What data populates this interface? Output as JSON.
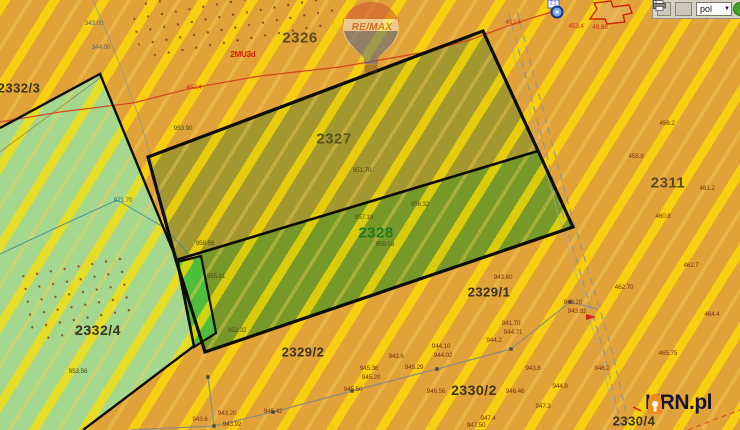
{
  "map": {
    "colors": {
      "orange": "#E2A23A",
      "stripe": "#FFE000",
      "lightgreen": "#A6D78E",
      "olive": "#A3972F",
      "green": "#76992A",
      "brightgreen": "#4FBE3C",
      "border": "#0D0D04"
    },
    "label_colors": {
      "red": "#C83010",
      "maroon": "#7A3410",
      "olive": "#4F4F10",
      "gray": "#5A6878",
      "teal": "#2A7A8A",
      "blue": "#2244CC",
      "zone": "#D42000"
    },
    "toolbar": {
      "language_value": "pol"
    },
    "watermark_remax": {
      "brand": "RE/MAX"
    },
    "watermark_krn": {
      "brand": "KRN.pl"
    },
    "parcel_labels": [
      {
        "text": "2326",
        "x": 300,
        "y": 38,
        "size": 15,
        "color": "#5C4B16"
      },
      {
        "text": "2327",
        "x": 334,
        "y": 139,
        "size": 15,
        "color": "#56561A"
      },
      {
        "text": "2328",
        "x": 376,
        "y": 233,
        "size": 15,
        "color": "#1E7A1E"
      },
      {
        "text": "2311",
        "x": 668,
        "y": 183,
        "size": 15,
        "color": "#5C4B16"
      },
      {
        "text": "2329/1",
        "x": 489,
        "y": 292,
        "size": 13,
        "color": "#3A3318"
      },
      {
        "text": "2329/2",
        "x": 303,
        "y": 352,
        "size": 13,
        "color": "#3A3318"
      },
      {
        "text": "2330/2",
        "x": 474,
        "y": 390,
        "size": 14,
        "color": "#3A3318"
      },
      {
        "text": "2330/4",
        "x": 634,
        "y": 421,
        "size": 13,
        "color": "#3A3318"
      },
      {
        "text": "2332/3",
        "x": 19,
        "y": 88,
        "size": 13,
        "color": "#3A3318"
      },
      {
        "text": "2332/4",
        "x": 98,
        "y": 330,
        "size": 14,
        "color": "#3A3318"
      }
    ],
    "micro_labels": [
      {
        "x": 94,
        "y": 24,
        "text": "343.00",
        "c": "gray"
      },
      {
        "x": 101,
        "y": 48,
        "text": "344.00",
        "c": "gray"
      },
      {
        "x": 243,
        "y": 55,
        "text": "2MU3d",
        "c": "zone",
        "size": 8,
        "bold": true
      },
      {
        "x": 194,
        "y": 88,
        "text": "452.4",
        "c": "red"
      },
      {
        "x": 513,
        "y": 23,
        "text": "452.4",
        "c": "red"
      },
      {
        "x": 576,
        "y": 27,
        "text": "453.4",
        "c": "red"
      },
      {
        "x": 600,
        "y": 28,
        "text": "49.88",
        "c": "red"
      },
      {
        "x": 553,
        "y": 4,
        "text": "2.1",
        "c": "blue",
        "size": 5
      },
      {
        "x": 667,
        "y": 124,
        "text": "456.2",
        "c": "maroon"
      },
      {
        "x": 636,
        "y": 157,
        "text": "458.8",
        "c": "maroon"
      },
      {
        "x": 707,
        "y": 189,
        "text": "461.2",
        "c": "maroon"
      },
      {
        "x": 663,
        "y": 217,
        "text": "460.8",
        "c": "maroon"
      },
      {
        "x": 691,
        "y": 266,
        "text": "462.7",
        "c": "maroon"
      },
      {
        "x": 624,
        "y": 288,
        "text": "462.70",
        "c": "maroon"
      },
      {
        "x": 712,
        "y": 315,
        "text": "464.4",
        "c": "maroon"
      },
      {
        "x": 668,
        "y": 354,
        "text": "465.75",
        "c": "maroon"
      },
      {
        "x": 183,
        "y": 129,
        "text": "953.90",
        "c": "olive"
      },
      {
        "x": 362,
        "y": 171,
        "text": "951.70",
        "c": "olive"
      },
      {
        "x": 420,
        "y": 205,
        "text": "956.32",
        "c": "olive"
      },
      {
        "x": 364,
        "y": 218,
        "text": "957.18",
        "c": "olive"
      },
      {
        "x": 205,
        "y": 244,
        "text": "958.56",
        "c": "olive"
      },
      {
        "x": 385,
        "y": 245,
        "text": "959.56",
        "c": "olive"
      },
      {
        "x": 216,
        "y": 277,
        "text": "955.81",
        "c": "olive"
      },
      {
        "x": 237,
        "y": 331,
        "text": "952.32",
        "c": "olive"
      },
      {
        "x": 78,
        "y": 372,
        "text": "953.56",
        "c": "olive"
      },
      {
        "x": 123,
        "y": 201,
        "text": "971.70",
        "c": "teal"
      },
      {
        "x": 503,
        "y": 278,
        "text": "943.60",
        "c": "maroon"
      },
      {
        "x": 573,
        "y": 303,
        "text": "943.20",
        "c": "maroon"
      },
      {
        "x": 577,
        "y": 312,
        "text": "943.92",
        "c": "maroon"
      },
      {
        "x": 511,
        "y": 324,
        "text": "941.70",
        "c": "maroon"
      },
      {
        "x": 513,
        "y": 333,
        "text": "944.71",
        "c": "maroon"
      },
      {
        "x": 494,
        "y": 341,
        "text": "944.2",
        "c": "maroon"
      },
      {
        "x": 441,
        "y": 347,
        "text": "944.10",
        "c": "maroon"
      },
      {
        "x": 443,
        "y": 356,
        "text": "944.02",
        "c": "maroon"
      },
      {
        "x": 414,
        "y": 368,
        "text": "945.29",
        "c": "maroon"
      },
      {
        "x": 533,
        "y": 369,
        "text": "943.8",
        "c": "maroon"
      },
      {
        "x": 602,
        "y": 369,
        "text": "946.2",
        "c": "maroon"
      },
      {
        "x": 560,
        "y": 387,
        "text": "944.8",
        "c": "maroon"
      },
      {
        "x": 436,
        "y": 392,
        "text": "946.56",
        "c": "maroon"
      },
      {
        "x": 515,
        "y": 392,
        "text": "946.46",
        "c": "maroon"
      },
      {
        "x": 543,
        "y": 407,
        "text": "947.3",
        "c": "maroon"
      },
      {
        "x": 488,
        "y": 419,
        "text": "947.4",
        "c": "maroon"
      },
      {
        "x": 476,
        "y": 426,
        "text": "947.50",
        "c": "maroon"
      },
      {
        "x": 369,
        "y": 369,
        "text": "945.36",
        "c": "maroon"
      },
      {
        "x": 371,
        "y": 378,
        "text": "945.20",
        "c": "maroon"
      },
      {
        "x": 396,
        "y": 357,
        "text": "943.6",
        "c": "maroon"
      },
      {
        "x": 353,
        "y": 390,
        "text": "945.50",
        "c": "maroon"
      },
      {
        "x": 273,
        "y": 412,
        "text": "945.42",
        "c": "maroon"
      },
      {
        "x": 227,
        "y": 414,
        "text": "943.20",
        "c": "maroon"
      },
      {
        "x": 200,
        "y": 420,
        "text": "943.6",
        "c": "maroon"
      },
      {
        "x": 232,
        "y": 425,
        "text": "943.92",
        "c": "maroon"
      }
    ]
  }
}
